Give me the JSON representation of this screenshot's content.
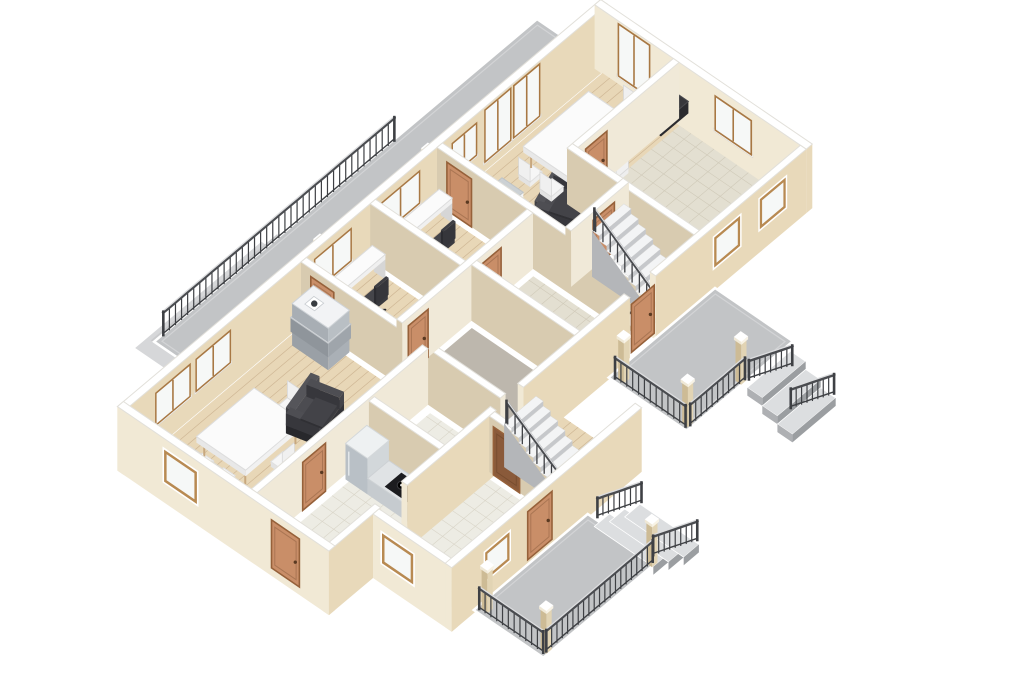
{
  "app": {
    "kind": "3d-floorplan-render",
    "background": "#ffffff"
  },
  "projection": {
    "ox": 130,
    "oy": 462,
    "ax": 0.76,
    "ay": -0.64,
    "bx": 0.82,
    "by": 0.56
  },
  "palette": {
    "wallTop": "#ffffff",
    "wallTopStroke": "#e2e0da",
    "intA": "#d8cbb0",
    "intB": "#f0e9d8",
    "extA": "#f1e9d5",
    "extB": "#e8d9ba",
    "wood": "#e8d7b7",
    "woodLine": "#cfb795",
    "tile": "#e3dfd1",
    "tileLine": "#d0cab9",
    "tile2": "#edece4",
    "tile2Line": "#d9d5c8",
    "plain": "#bdb7ad",
    "deck": "#c2c4c6",
    "deckInner": "#d3d4d6",
    "stepTop": "#dcdee0",
    "stepRiser": "#9b9ea1",
    "stepSide": "#aeb0b3",
    "railDark": "#3e4044",
    "railLight": "#dcdddf",
    "postA": "#cdbb95",
    "postB": "#e2d4b4",
    "door": "#c98e68",
    "doorDark": "#8a5a3a",
    "doorFrame": "#96613a",
    "winFrame": "#a87844",
    "glass": "#f6f8f7",
    "sill": "#ffffff",
    "stairTread": "#f3f4f5",
    "stairRiser": "#c6c8cb",
    "stairFlank": "#b4b6b9",
    "darkFurn": "#303034",
    "darkFurnTop": "#45454a",
    "whiteFurn": "#fbfbfb",
    "whiteFurnSide": "#e6e6e6",
    "legTan": "#c8a87e",
    "grayBox1": "#aab0b6",
    "grayBox2": "#9aa0a6",
    "grayBox3": "#b9bfc4",
    "fridgeA": "#b9c0c6",
    "fridgeB": "#d2d7da",
    "counterTop": "#e0e3e5",
    "counterA": "#c6cbcf",
    "counterB": "#d8dcdf",
    "cooktop": "#1c1c1f"
  },
  "items": [
    {
      "t": "deckpad",
      "name": "balcony-pad-outer",
      "r": [
        104,
        -90,
        270,
        -2
      ],
      "z": -3,
      "fill": "#d6d7d9"
    },
    {
      "t": "deckpad",
      "name": "balcony-pad-inner",
      "r": [
        118,
        -84,
        284,
        4
      ],
      "z": -1,
      "fill": "#c9cacc"
    },
    {
      "t": "deck",
      "name": "balcony-deck",
      "r": [
        118,
        -80,
        622,
        -6
      ],
      "z": 0
    },
    {
      "t": "railing",
      "name": "balcony-railing",
      "pts": [
        [
          128,
          -78,
          0
        ],
        [
          432,
          -78,
          0
        ]
      ],
      "h": 24,
      "sp": 8
    },
    {
      "t": "post",
      "name": "balcony-post-1",
      "at": [
        258,
        -14
      ],
      "h": 50
    },
    {
      "t": "post",
      "name": "balcony-post-2",
      "at": [
        400,
        -14
      ],
      "h": 50
    },
    {
      "t": "wall",
      "name": "wall-exterior-nw",
      "r": [
        -8,
        -8,
        628,
        0
      ],
      "ext": true
    },
    {
      "t": "window",
      "name": "window-living-1",
      "plane": "v",
      "at": 0,
      "a": 35,
      "b": 78,
      "z1": 16,
      "z2": 46,
      "style": "in"
    },
    {
      "t": "window",
      "name": "window-living-2",
      "plane": "v",
      "at": 0,
      "a": 88,
      "b": 131,
      "z1": 16,
      "z2": 46,
      "style": "in"
    },
    {
      "t": "window",
      "name": "window-office-b",
      "plane": "v",
      "at": 0,
      "a": 244,
      "b": 290,
      "z1": 16,
      "z2": 46,
      "style": "in"
    },
    {
      "t": "window",
      "name": "window-office-a",
      "plane": "v",
      "at": 0,
      "a": 332,
      "b": 380,
      "z1": 16,
      "z2": 46,
      "style": "in"
    },
    {
      "t": "window",
      "name": "window-dining",
      "plane": "v",
      "at": 0,
      "a": 425,
      "b": 455,
      "z1": 16,
      "z2": 46,
      "style": "in"
    },
    {
      "t": "window",
      "name": "french-door-1",
      "plane": "v",
      "at": 0,
      "a": 468,
      "b": 500,
      "z1": 2,
      "z2": 52,
      "style": "in"
    },
    {
      "t": "window",
      "name": "french-door-2",
      "plane": "v",
      "at": 0,
      "a": 506,
      "b": 538,
      "z1": 2,
      "z2": 52,
      "style": "in"
    },
    {
      "t": "wall",
      "name": "wall-exterior-ne",
      "r": [
        620,
        -8,
        628,
        250
      ],
      "ext": true
    },
    {
      "t": "window",
      "name": "window-ne-tall",
      "plane": "u",
      "at": 620,
      "a": 22,
      "b": 58,
      "z1": 2,
      "z2": 52,
      "style": "in"
    },
    {
      "t": "window",
      "name": "window-east-room",
      "plane": "u",
      "at": 620,
      "a": 140,
      "b": 182,
      "z1": 14,
      "z2": 46,
      "style": "in"
    },
    {
      "t": "floor",
      "name": "floor-dining-room",
      "r": [
        417,
        7,
        614,
        144
      ],
      "fin": "wood"
    },
    {
      "t": "floor",
      "name": "floor-office-a",
      "r": [
        329,
        7,
        398,
        104
      ],
      "fin": "wood"
    },
    {
      "t": "floor",
      "name": "floor-office-b",
      "r": [
        238,
        7,
        310,
        104
      ],
      "fin": "wood"
    },
    {
      "t": "floor",
      "name": "floor-living-room",
      "r": [
        6,
        7,
        219,
        142
      ],
      "fin": "wood"
    },
    {
      "t": "floor",
      "name": "floor-hall-west",
      "r": [
        238,
        123,
        317,
        237
      ],
      "fin": "plain"
    },
    {
      "t": "floor",
      "name": "floor-hall-east",
      "r": [
        336,
        123,
        398,
        237
      ],
      "fin": "tile"
    },
    {
      "t": "floor",
      "name": "floor-stair-hall",
      "r": [
        417,
        163,
        474,
        237
      ],
      "fin": "tile"
    },
    {
      "t": "floor",
      "name": "floor-east-room",
      "r": [
        493,
        101,
        614,
        237
      ],
      "fin": "tile"
    },
    {
      "t": "floor",
      "name": "floor-bathroom",
      "r": [
        158,
        163,
        219,
        237
      ],
      "fin": "tile2"
    },
    {
      "t": "floor",
      "name": "floor-kitchen",
      "r": [
        6,
        163,
        139,
        237
      ],
      "fin": "tile2"
    },
    {
      "t": "floor",
      "name": "floor-entry",
      "r": [
        64,
        256,
        197,
        332
      ],
      "fin": "tile2"
    },
    {
      "t": "floor",
      "name": "floor-stair-room",
      "r": [
        216,
        256,
        294,
        332
      ],
      "fin": "wood"
    },
    {
      "t": "appliance",
      "name": "ac-unit",
      "r": [
        416,
        44,
        442,
        70
      ]
    },
    {
      "t": "sofa",
      "name": "armchair-dining",
      "r": [
        446,
        76,
        494,
        114
      ],
      "rot": -18
    },
    {
      "t": "tableset",
      "name": "dining-table-upper",
      "c": [
        528,
        62
      ],
      "w": 86,
      "d": 64
    },
    {
      "t": "tv",
      "name": "tv-east-room",
      "r": [
        580,
        95,
        616,
        110
      ]
    },
    {
      "t": "wall",
      "name": "wall-dining-west",
      "r": [
        404,
        0,
        411,
        243
      ]
    },
    {
      "t": "door",
      "name": "door-dining",
      "plane": "u",
      "at": 404,
      "a": 12,
      "b": 42,
      "face": "A"
    },
    {
      "t": "desk",
      "name": "desk-office-a",
      "r": [
        330,
        10,
        396,
        26
      ]
    },
    {
      "t": "officechair",
      "name": "chair-office-a",
      "at": [
        362,
        46
      ]
    },
    {
      "t": "wall",
      "name": "wall-office-divider",
      "r": [
        316,
        0,
        323,
        110
      ]
    },
    {
      "t": "desk",
      "name": "desk-office-b",
      "r": [
        242,
        10,
        308,
        26
      ]
    },
    {
      "t": "officechair",
      "name": "chair-office-b",
      "at": [
        274,
        46
      ]
    },
    {
      "t": "wall",
      "name": "wall-living-east",
      "r": [
        225,
        0,
        232,
        243
      ]
    },
    {
      "t": "door",
      "name": "door-living",
      "plane": "u",
      "at": 225,
      "a": 12,
      "b": 40,
      "face": "A"
    },
    {
      "t": "stack",
      "name": "cabinet-stack",
      "at": [
        196,
        16
      ]
    },
    {
      "t": "tableset",
      "name": "dining-table-living",
      "c": [
        80,
        72
      ],
      "w": 76,
      "d": 60
    },
    {
      "t": "sofa",
      "name": "armchair-living",
      "r": [
        120,
        76,
        166,
        110
      ],
      "rot": -14
    },
    {
      "t": "wall",
      "name": "wall-offices-south",
      "r": [
        232,
        110,
        404,
        117
      ]
    },
    {
      "t": "door",
      "name": "door-office-b",
      "plane": "v",
      "at": 117,
      "a": 240,
      "b": 266,
      "face": "B"
    },
    {
      "t": "door",
      "name": "door-office-a",
      "plane": "v",
      "at": 117,
      "a": 336,
      "b": 362,
      "face": "B"
    },
    {
      "t": "wall",
      "name": "wall-living-south",
      "r": [
        0,
        148,
        225,
        155
      ]
    },
    {
      "t": "door",
      "name": "door-kitchen",
      "plane": "v",
      "at": 155,
      "a": 60,
      "b": 90,
      "face": "B"
    },
    {
      "t": "wall",
      "name": "wall-east-north",
      "r": [
        487,
        88,
        620,
        95
      ]
    },
    {
      "t": "door",
      "name": "door-east-room",
      "plane": "v",
      "at": 95,
      "a": 497,
      "b": 525,
      "face": "B"
    },
    {
      "t": "wall",
      "name": "wall-east-west",
      "r": [
        480,
        88,
        487,
        250
      ]
    },
    {
      "t": "wall",
      "name": "wall-stairhall-north",
      "r": [
        411,
        150,
        487,
        157
      ]
    },
    {
      "t": "door",
      "name": "door-stair-hall",
      "plane": "v",
      "at": 157,
      "a": 440,
      "b": 468,
      "face": "B"
    },
    {
      "t": "stairs",
      "name": "staircase-main",
      "u1": 432,
      "u2": 474,
      "vT": 163,
      "vB": 243,
      "zT": 46,
      "n": 9,
      "turn": true
    },
    {
      "t": "wall",
      "name": "wall-center-divider",
      "r": [
        323,
        117,
        330,
        243
      ]
    },
    {
      "t": "sink",
      "name": "bathroom-sink",
      "r": [
        156,
        160,
        180,
        178
      ]
    },
    {
      "t": "wall",
      "name": "wall-bath-west",
      "r": [
        145,
        157,
        152,
        243
      ]
    },
    {
      "t": "fridge",
      "name": "fridge",
      "r": [
        112,
        159,
        140,
        186
      ]
    },
    {
      "t": "counter",
      "name": "kitchen-counter",
      "r": [
        112,
        186,
        140,
        240
      ]
    },
    {
      "t": "wall",
      "name": "wall-se-1",
      "r": [
        -8,
        243,
        60,
        250
      ],
      "ext": true
    },
    {
      "t": "wall",
      "name": "wall-se-2",
      "r": [
        95,
        243,
        212,
        250
      ],
      "ext": true
    },
    {
      "t": "wall",
      "name": "wall-se-3",
      "r": [
        248,
        243,
        388,
        250
      ],
      "ext": true
    },
    {
      "t": "wall",
      "name": "wall-se-4",
      "r": [
        422,
        243,
        620,
        250
      ],
      "ext": true
    },
    {
      "t": "door",
      "name": "door-right-porch",
      "plane": "v",
      "at": 250,
      "a": 390,
      "b": 420,
      "face": "B"
    },
    {
      "t": "window",
      "name": "window-se-1",
      "plane": "v",
      "at": 250,
      "a": 500,
      "b": 532,
      "z1": 16,
      "z2": 44,
      "style": "recess"
    },
    {
      "t": "window",
      "name": "window-se-2",
      "plane": "v",
      "at": 250,
      "a": 560,
      "b": 592,
      "z1": 16,
      "z2": 44,
      "style": "recess"
    },
    {
      "t": "wall",
      "name": "wall-exterior-sw",
      "r": [
        -8,
        -8,
        0,
        250
      ],
      "ext": true
    },
    {
      "t": "door",
      "name": "door-entry-sw",
      "plane": "u",
      "at": -8,
      "a": 180,
      "b": 214,
      "face": "A"
    },
    {
      "t": "window",
      "name": "window-sw",
      "plane": "u",
      "at": -8,
      "a": 50,
      "b": 88,
      "z1": 14,
      "z2": 44,
      "style": "recess"
    },
    {
      "t": "wall",
      "name": "wall-wing-divider",
      "r": [
        203,
        250,
        210,
        338
      ]
    },
    {
      "t": "door",
      "name": "door-stair-room",
      "plane": "u",
      "at": 203,
      "a": 255,
      "b": 287,
      "face": "A",
      "dark": true
    },
    {
      "t": "stairs",
      "name": "staircase-wing",
      "u1": 216,
      "u2": 258,
      "vT": 256,
      "vB": 336,
      "zT": 44,
      "n": 9,
      "turn": false
    },
    {
      "t": "wall",
      "name": "wall-wing-sw",
      "r": [
        50,
        250,
        58,
        346
      ],
      "ext": true
    },
    {
      "t": "window",
      "name": "window-wing-sw",
      "plane": "u",
      "at": 50,
      "a": 262,
      "b": 298,
      "z1": 14,
      "z2": 42,
      "style": "recess"
    },
    {
      "t": "wall",
      "name": "wall-wing-se",
      "r": [
        50,
        338,
        300,
        346
      ],
      "ext": true
    },
    {
      "t": "door",
      "name": "door-bottom-porch",
      "plane": "v",
      "at": 346,
      "a": 150,
      "b": 182,
      "face": "B"
    },
    {
      "t": "window",
      "name": "window-wing-se",
      "plane": "v",
      "at": 346,
      "a": 95,
      "b": 125,
      "z1": 16,
      "z2": 42,
      "style": "recess"
    },
    {
      "t": "deck",
      "name": "right-porch-deck",
      "r": [
        360,
        250,
        500,
        345
      ],
      "z": -6
    },
    {
      "t": "steps",
      "name": "right-porch-steps",
      "dir": "+v",
      "r": [
        440,
        345,
        497,
        400
      ],
      "n": 3,
      "z0": -6
    },
    {
      "t": "post",
      "name": "right-porch-post-1",
      "at": [
        364,
        258
      ],
      "h": 44,
      "z": -6
    },
    {
      "t": "post",
      "name": "right-porch-post-2",
      "at": [
        364,
        336
      ],
      "h": 44,
      "z": -6
    },
    {
      "t": "post",
      "name": "right-porch-post-3",
      "at": [
        432,
        338
      ],
      "h": 44,
      "z": -6
    },
    {
      "t": "railing",
      "name": "right-porch-rail-w",
      "pts": [
        [
          362,
          256,
          -6
        ],
        [
          362,
          342,
          -6
        ]
      ],
      "h": 22,
      "sp": 7
    },
    {
      "t": "railing",
      "name": "right-porch-rail-s",
      "pts": [
        [
          366,
          344,
          -6
        ],
        [
          438,
          344,
          -6
        ]
      ],
      "h": 22,
      "sp": 7
    },
    {
      "t": "railing",
      "name": "right-porch-steps-rail-1",
      "pts": [
        [
          440,
          347,
          -6
        ],
        [
          497,
          347,
          -28
        ]
      ],
      "h": 20,
      "sp": 7
    },
    {
      "t": "railing",
      "name": "right-porch-steps-rail-2",
      "pts": [
        [
          440,
          398,
          -6
        ],
        [
          497,
          398,
          -28
        ]
      ],
      "h": 20,
      "sp": 7
    },
    {
      "t": "deck",
      "name": "bottom-porch-deck",
      "r": [
        80,
        345,
        230,
        430
      ],
      "z": -6
    },
    {
      "t": "steps",
      "name": "bottom-porch-steps",
      "dir": "+u",
      "r": [
        230,
        353,
        290,
        425
      ],
      "n": 3,
      "z0": -6
    },
    {
      "t": "post",
      "name": "bottom-porch-post-1",
      "at": [
        85,
        350
      ],
      "h": 44,
      "z": -6
    },
    {
      "t": "post",
      "name": "bottom-porch-post-2",
      "at": [
        85,
        422
      ],
      "h": 44,
      "z": -6
    },
    {
      "t": "post",
      "name": "bottom-porch-post-3",
      "at": [
        222,
        424
      ],
      "h": 44,
      "z": -6
    },
    {
      "t": "railing",
      "name": "bottom-porch-rail-w",
      "pts": [
        [
          83,
          349,
          -6
        ],
        [
          83,
          427,
          -6
        ]
      ],
      "h": 22,
      "sp": 7
    },
    {
      "t": "railing",
      "name": "bottom-porch-rail-s",
      "pts": [
        [
          86,
          428,
          -6
        ],
        [
          226,
          428,
          -6
        ]
      ],
      "h": 22,
      "sp": 7
    },
    {
      "t": "railing",
      "name": "bottom-porch-steps-rail-1",
      "pts": [
        [
          232,
          355,
          -6
        ],
        [
          290,
          355,
          -28
        ]
      ],
      "h": 20,
      "sp": 7
    },
    {
      "t": "railing",
      "name": "bottom-porch-steps-rail-2",
      "pts": [
        [
          232,
          423,
          -6
        ],
        [
          290,
          423,
          -28
        ]
      ],
      "h": 20,
      "sp": 7
    }
  ]
}
